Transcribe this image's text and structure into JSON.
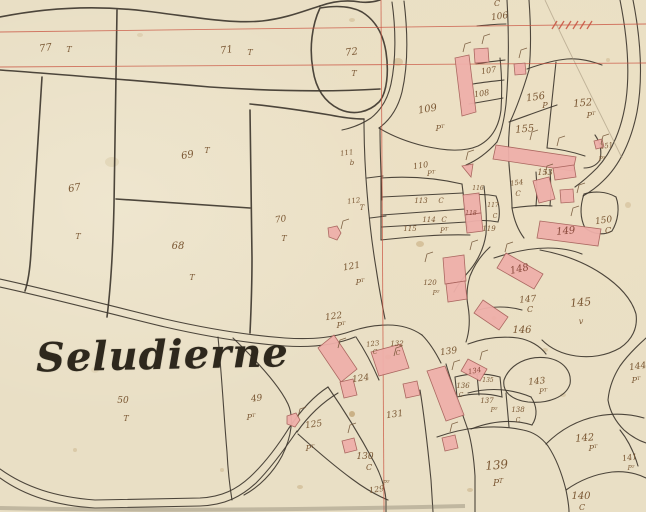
{
  "map": {
    "title": "Seludierne",
    "colors": {
      "paper": "#e9dfc5",
      "ink": "#3b342b",
      "sepia": "#7a5733",
      "building_fill": "#efb0aa",
      "building_stroke": "#a8625c",
      "red_grid": "#c8503e",
      "stain": "#b08a52"
    },
    "grid": {
      "red_lines": [
        "M0,32 L646,24",
        "M0,67 L646,63",
        "M381,0 L384,512"
      ],
      "hatches": [
        552,
        559,
        566,
        573,
        580,
        587
      ],
      "hatch_y": 29
    },
    "faint_paths": [
      "M545,0 C568,50 596,105 622,158"
    ],
    "boundaries": [
      "M0,17 C45,8 95,5 145,11 C195,17 230,24 262,21 C288,18 306,10 320,6",
      "M320,6 C334,1 348,0 360,2 C368,3 374,2 380,0",
      "M320,8 C312,25 309,48 313,70 C316,90 325,102 339,109 C354,116 369,112 379,102 C387,93 389,72 386,52 C383,33 375,20 362,12 C349,5 332,6 320,8",
      "M0,70 C70,75 140,81 210,87 C270,91 330,92 380,89",
      "M42,77 C38,140 34,200 31,252 C30,270 28,282 25,291",
      "M117,10 C116,80 115,150 114,205 C113,250 111,285 107,317",
      "M116,199 C160,202 205,205 250,208",
      "M250,110 C251,160 251,210 252,258 C252,288 251,312 250,333",
      "M250,104 C280,107 306,111 330,115 C345,118 356,119 364,119",
      "M392,2 C396,30 396,60 391,84 C388,98 381,110 371,118 C362,124 352,128 342,130",
      "M404,1 C408,34 408,66 402,92 C398,108 390,120 379,128",
      "M379,128 C392,136 408,142 424,146 C446,151 464,152 478,146 C492,139 499,126 501,110 C502,94 502,76 500,58",
      "M364,119 C364,144 365,168 367,192 C369,218 372,244 376,268 C379,288 382,304 385,319",
      "M380,128 C380,152 381,176 382,200",
      "M367,178 L383,176",
      "M370,218 L386,216",
      "M381,178 C408,176 436,178 462,184",
      "M382,197 L463,193",
      "M382,215 L465,209",
      "M382,227 L467,222",
      "M381,240 C410,237 440,234 470,235",
      "M381,178 L381,240",
      "M462,184 C464,200 466,216 468,230",
      "M0,279 C55,291 115,307 165,319 C200,327 245,335 285,338 C315,340 335,337 352,331",
      "M0,287 C55,299 115,315 165,327 C200,335 245,343 285,346 C316,348 338,344 355,337",
      "M218,337 C222,378 224,418 227,452 C228,472 230,488 232,500",
      "M233,338 C262,366 280,387 288,404 C294,417 292,436 282,456 C273,473 259,487 244,495",
      "M0,469 C25,487 55,497 95,500 L200,498 C222,497 237,489 250,477 C264,464 277,447 289,428",
      "M0,478 C25,496 58,506 95,508 L200,506 C226,505 242,496 256,483 C270,469 284,450 297,431",
      "M289,428 C301,410 314,396 328,387",
      "M297,432 C309,415 323,402 338,393",
      "M328,387 C344,410 360,436 374,462 C381,475 385,488 386,500 L386,512",
      "M298,434 C318,452 337,468 352,479 C364,488 376,495 388,500",
      "M352,331 C364,327 376,325 388,325 C400,325 412,328 422,335",
      "M356,337 C366,352 373,366 379,380",
      "M422,335 C430,343 436,353 441,363",
      "M420,390 C425,420 428,450 431,480 L433,512",
      "M446,364 C453,388 461,410 468,430 C472,444 474,460 475,476 L475,512",
      "M437,437 C465,427 496,424 523,430 C534,432 542,438 548,446 C556,458 562,474 566,490 C568,500 569,507 569,512",
      "M468,393 C490,387 512,389 531,397",
      "M471,429 C492,421 513,419 532,425",
      "M506,393 L509,427",
      "M531,397 C537,406 538,416 532,425",
      "M455,377 C470,373 486,373 500,377 L502,397 C488,393 472,393 457,397 L455,377",
      "M477,375 L479,395",
      "M504,380 C510,364 528,355 548,358 C564,361 572,372 570,384 C566,397 548,404 528,402 C512,400 502,392 504,380",
      "M478,310 C492,306 508,306 522,310",
      "M468,344 C484,338 502,336 518,338 C530,340 540,346 546,354",
      "M540,250 C562,254 584,262 602,274 C620,286 632,300 636,314 C638,328 632,340 620,348 C606,356 590,358 576,356 C562,354 550,348 542,340",
      "M584,194 C580,206 580,218 585,228 C593,234 603,236 612,231 C618,221 620,208 616,197 C606,191 593,191 584,194",
      "M620,0 C627,35 630,70 626,100 C622,128 612,152 597,168 C589,176 582,182 575,187",
      "M633,0 C641,40 643,80 637,112 C631,142 619,166 603,181 C597,187 590,192 583,196",
      "M556,62 C553,90 550,119 547,148",
      "M527,69 C541,64 555,60 567,59 C579,58 591,61 602,65",
      "M509,122 C526,116 542,110 557,105",
      "M547,148 C560,149 573,152 585,156",
      "M595,135 C600,142 602,151 600,160 C596,166 590,168 584,168",
      "M646,338 C636,347 627,356 620,366 C613,377 609,389 608,400 C610,412 616,422 624,430 C632,437 640,441 646,443",
      "M546,444 C560,430 578,420 598,416 C614,413 630,414 644,418",
      "M566,490 C580,480 596,474 612,472 C624,471 636,473 646,478",
      "M620,430 C628,440 634,452 638,466",
      "M507,0 C509,35 509,70 506,104 C504,122 501,133 497,142",
      "M529,0 C531,28 531,52 529,70",
      "M529,70 C523,90 517,107 510,122",
      "M477,26 C487,25 497,24 506,24",
      "M476,64 C486,62 496,61 505,60",
      "M473,84 C484,82 495,81 504,80",
      "M469,104 C481,102 493,100 503,98",
      "M484,186 C486,204 487,220 486,234 C484,248 478,260 470,270 C464,277 458,284 454,292",
      "M466,196 C476,194 486,194 496,196 C500,206 500,216 498,222 C488,220 478,220 468,222",
      "M497,142 C488,152 478,160 466,165",
      "M490,247 C480,256 474,266 470,276 C467,286 466,296 468,306",
      "M468,306 C470,318 470,330 466,342",
      "M510,122 C508,140 508,158 510,176 C511,188 512,198 512,208",
      "M512,208 C514,220 518,230 524,238",
      "M536,172 C537,184 537,196 536,206",
      "M550,170 C551,184 551,196 550,206",
      "M512,208 C526,206 540,205 552,206",
      "M494,258 C512,252 530,248 548,248 C560,248 572,250 582,254"
    ],
    "buildings": [
      "455,58 469,55 476,112 462,116",
      "474,49 488,48 489,62 475,63",
      "514,64 525,63 526,74 515,75",
      "496,145 576,157 573,171 493,159",
      "553,168 574,165 576,177 555,180",
      "533,181 549,177 555,199 539,203",
      "560,190 573,189 574,202 561,203",
      "540,221 601,229 598,246 537,238",
      "506,253 543,274 534,289 497,268",
      "483,300 508,317 499,330 474,313",
      "468,359 487,369 480,381 461,371",
      "463,195 479,193 481,213 465,215",
      "465,215 481,213 483,231 467,233",
      "462,166 473,164 471,177",
      "328,228 337,226 341,233 337,240 329,237",
      "334,335 357,369 341,382 318,348",
      "371,352 401,344 409,368 379,376",
      "340,382 353,379 357,395 344,398",
      "403,384 417,381 420,395 406,398",
      "427,371 445,366 464,415 446,421",
      "442,438 455,435 458,448 445,451",
      "287,416 296,413 300,420 295,427 287,424",
      "342,441 354,438 357,450 345,453",
      "594,141 602,139 604,147 596,149",
      "443,258 464,255 466,281 445,284",
      "446,284 465,281 467,299 448,302"
    ],
    "ticks": [
      [
        463,
        52
      ],
      [
        482,
        44
      ],
      [
        519,
        58
      ],
      [
        530,
        140
      ],
      [
        557,
        146
      ],
      [
        571,
        216
      ],
      [
        545,
        174
      ],
      [
        577,
        193
      ],
      [
        480,
        360
      ],
      [
        341,
        229
      ],
      [
        298,
        417
      ],
      [
        348,
        433
      ],
      [
        450,
        432
      ],
      [
        394,
        356
      ],
      [
        452,
        370
      ],
      [
        470,
        250
      ],
      [
        466,
        160
      ],
      [
        425,
        262
      ],
      [
        505,
        252
      ],
      [
        601,
        144
      ],
      [
        338,
        348
      ]
    ],
    "stains": [
      [
        398,
        62,
        5,
        4,
        0.3
      ],
      [
        352,
        20,
        3,
        2,
        0.25
      ],
      [
        420,
        244,
        4,
        3,
        0.35
      ],
      [
        300,
        487,
        3,
        2,
        0.3
      ],
      [
        598,
        232,
        2,
        2,
        0.3
      ],
      [
        112,
        162,
        7,
        5,
        0.15
      ],
      [
        545,
        350,
        3,
        2,
        0.25
      ],
      [
        628,
        205,
        3,
        3,
        0.25
      ],
      [
        75,
        450,
        2,
        2,
        0.25
      ],
      [
        563,
        395,
        3,
        2,
        0.2
      ],
      [
        222,
        470,
        2,
        2,
        0.25
      ],
      [
        470,
        490,
        3,
        2,
        0.3
      ],
      [
        608,
        60,
        2,
        2,
        0.25
      ],
      [
        140,
        35,
        3,
        2,
        0.18
      ],
      [
        95,
        370,
        4,
        3,
        0.12
      ],
      [
        352,
        414,
        3,
        3,
        0.55
      ],
      [
        494,
        318,
        2.5,
        2,
        0.5
      ],
      [
        388,
        357,
        3,
        2.5,
        0.45
      ]
    ],
    "parcel_labels": [
      {
        "t": "77",
        "x": 46,
        "y": 51,
        "s": 10,
        "r": -8
      },
      {
        "t": "T",
        "x": 69,
        "y": 52,
        "s": 8
      },
      {
        "t": "71",
        "x": 227,
        "y": 53,
        "s": 10,
        "r": -8
      },
      {
        "t": "T",
        "x": 250,
        "y": 55,
        "s": 8
      },
      {
        "t": "72",
        "x": 352,
        "y": 55,
        "s": 10,
        "r": -8
      },
      {
        "t": "T",
        "x": 354,
        "y": 76,
        "s": 8
      },
      {
        "t": "69",
        "x": 188,
        "y": 158,
        "s": 10,
        "r": -10
      },
      {
        "t": "T",
        "x": 207,
        "y": 153,
        "s": 8
      },
      {
        "t": "67",
        "x": 75,
        "y": 191,
        "s": 10,
        "r": -10
      },
      {
        "t": "T",
        "x": 78,
        "y": 239,
        "s": 8
      },
      {
        "t": "68",
        "x": 178,
        "y": 249,
        "s": 10
      },
      {
        "t": "T",
        "x": 192,
        "y": 280,
        "s": 8
      },
      {
        "t": "70",
        "x": 281,
        "y": 222,
        "s": 9,
        "r": -8
      },
      {
        "t": "T",
        "x": 284,
        "y": 241,
        "s": 8
      },
      {
        "t": "50",
        "x": 123,
        "y": 403,
        "s": 9
      },
      {
        "t": "T",
        "x": 126,
        "y": 421,
        "s": 8
      },
      {
        "t": "49",
        "x": 257,
        "y": 401,
        "s": 9,
        "r": -8
      },
      {
        "t": "P^T",
        "x": 251,
        "y": 420,
        "s": 8
      },
      {
        "t": "125",
        "x": 314,
        "y": 427,
        "s": 9,
        "r": -8
      },
      {
        "t": "P^T",
        "x": 310,
        "y": 451,
        "s": 8
      },
      {
        "t": "C",
        "x": 497,
        "y": 6,
        "s": 8
      },
      {
        "t": "106",
        "x": 500,
        "y": 19,
        "s": 9,
        "r": -8
      },
      {
        "t": "107",
        "x": 489,
        "y": 73,
        "s": 8,
        "r": -8
      },
      {
        "t": "108",
        "x": 482,
        "y": 96,
        "s": 8,
        "r": -8
      },
      {
        "t": "109",
        "x": 428,
        "y": 112,
        "s": 10,
        "r": -10
      },
      {
        "t": "P^T",
        "x": 440,
        "y": 131,
        "s": 8
      },
      {
        "t": "110",
        "x": 421,
        "y": 168,
        "s": 8,
        "r": -8
      },
      {
        "t": "P^T",
        "x": 431,
        "y": 176,
        "s": 7
      },
      {
        "t": "111",
        "x": 347,
        "y": 155,
        "s": 7,
        "r": -8
      },
      {
        "t": "b",
        "x": 352,
        "y": 165,
        "s": 7
      },
      {
        "t": "112",
        "x": 354,
        "y": 203,
        "s": 7,
        "r": -8
      },
      {
        "t": "T",
        "x": 362,
        "y": 210,
        "s": 7
      },
      {
        "t": "113",
        "x": 421,
        "y": 203,
        "s": 7
      },
      {
        "t": "C",
        "x": 441,
        "y": 203,
        "s": 7
      },
      {
        "t": "114",
        "x": 429,
        "y": 222,
        "s": 7
      },
      {
        "t": "C",
        "x": 444,
        "y": 222,
        "s": 7
      },
      {
        "t": "115",
        "x": 410,
        "y": 231,
        "s": 7
      },
      {
        "t": "P^T",
        "x": 444,
        "y": 233,
        "s": 7
      },
      {
        "t": "116",
        "x": 478,
        "y": 190,
        "s": 6
      },
      {
        "t": "117",
        "x": 493,
        "y": 207,
        "s": 6
      },
      {
        "t": "C",
        "x": 495,
        "y": 218,
        "s": 6
      },
      {
        "t": "118",
        "x": 471,
        "y": 215,
        "s": 6,
        "c": "#8a4a3c"
      },
      {
        "t": "119",
        "x": 489,
        "y": 231,
        "s": 7
      },
      {
        "t": "120",
        "x": 430,
        "y": 285,
        "s": 7
      },
      {
        "t": "P^T",
        "x": 436,
        "y": 295,
        "s": 6
      },
      {
        "t": "156",
        "x": 536,
        "y": 100,
        "s": 10,
        "r": -8
      },
      {
        "t": "P",
        "x": 545,
        "y": 108,
        "s": 8
      },
      {
        "t": "152",
        "x": 583,
        "y": 106,
        "s": 10,
        "r": -5
      },
      {
        "t": "P^T",
        "x": 591,
        "y": 118,
        "s": 8
      },
      {
        "t": "155",
        "x": 525,
        "y": 132,
        "s": 10,
        "r": -5
      },
      {
        "t": "153",
        "x": 545,
        "y": 175,
        "s": 8
      },
      {
        "t": "154",
        "x": 517,
        "y": 185,
        "s": 7,
        "r": -8
      },
      {
        "t": "C",
        "x": 518,
        "y": 196,
        "s": 7
      },
      {
        "t": "151",
        "x": 607,
        "y": 148,
        "s": 7,
        "r": -10
      },
      {
        "t": "P^T",
        "x": 602,
        "y": 161,
        "s": 6
      },
      {
        "t": "150",
        "x": 604,
        "y": 223,
        "s": 9,
        "r": -8
      },
      {
        "t": "C",
        "x": 608,
        "y": 233,
        "s": 8
      },
      {
        "t": "149",
        "x": 566,
        "y": 234,
        "s": 10,
        "r": -5,
        "c": "#8a4a3c"
      },
      {
        "t": "148",
        "x": 520,
        "y": 272,
        "s": 10,
        "r": -12,
        "c": "#8a4a3c"
      },
      {
        "t": "147",
        "x": 528,
        "y": 302,
        "s": 9,
        "r": -5
      },
      {
        "t": "C",
        "x": 530,
        "y": 312,
        "s": 8
      },
      {
        "t": "146",
        "x": 522,
        "y": 333,
        "s": 10
      },
      {
        "t": "145",
        "x": 581,
        "y": 306,
        "s": 11,
        "r": -5
      },
      {
        "t": "v",
        "x": 581,
        "y": 324,
        "s": 8
      },
      {
        "t": "144",
        "x": 638,
        "y": 369,
        "s": 9,
        "r": -8
      },
      {
        "t": "P^T",
        "x": 636,
        "y": 383,
        "s": 8
      },
      {
        "t": "143",
        "x": 537,
        "y": 384,
        "s": 9,
        "r": -5
      },
      {
        "t": "P^T",
        "x": 543,
        "y": 394,
        "s": 7
      },
      {
        "t": "134",
        "x": 475,
        "y": 373,
        "s": 7,
        "r": -10,
        "c": "#8a4a3c"
      },
      {
        "t": "136",
        "x": 463,
        "y": 388,
        "s": 7
      },
      {
        "t": "C",
        "x": 461,
        "y": 397,
        "s": 6
      },
      {
        "t": "135",
        "x": 488,
        "y": 382,
        "s": 6
      },
      {
        "t": "137",
        "x": 487,
        "y": 403,
        "s": 7
      },
      {
        "t": "P^T",
        "x": 494,
        "y": 412,
        "s": 6
      },
      {
        "t": "138",
        "x": 518,
        "y": 412,
        "s": 7
      },
      {
        "t": "C",
        "x": 518,
        "y": 422,
        "s": 6
      },
      {
        "t": "142",
        "x": 585,
        "y": 441,
        "s": 10,
        "r": -5
      },
      {
        "t": "P^T",
        "x": 593,
        "y": 451,
        "s": 8
      },
      {
        "t": "141",
        "x": 630,
        "y": 460,
        "s": 8,
        "r": -8
      },
      {
        "t": "P^T",
        "x": 631,
        "y": 470,
        "s": 6
      },
      {
        "t": "140",
        "x": 581,
        "y": 499,
        "s": 10
      },
      {
        "t": "C",
        "x": 582,
        "y": 510,
        "s": 8
      },
      {
        "t": "139",
        "x": 497,
        "y": 469,
        "s": 12,
        "r": -5
      },
      {
        "t": "P^T",
        "x": 498,
        "y": 486,
        "s": 9
      },
      {
        "t": "139",
        "x": 449,
        "y": 354,
        "s": 9,
        "r": -8
      },
      {
        "t": "121",
        "x": 352,
        "y": 269,
        "s": 9,
        "r": -10
      },
      {
        "t": "P^T",
        "x": 360,
        "y": 285,
        "s": 8
      },
      {
        "t": "122",
        "x": 334,
        "y": 319,
        "s": 9,
        "r": -8
      },
      {
        "t": "P^T",
        "x": 341,
        "y": 328,
        "s": 8
      },
      {
        "t": "123",
        "x": 373,
        "y": 346,
        "s": 7,
        "r": -8
      },
      {
        "t": "C",
        "x": 375,
        "y": 354,
        "s": 6
      },
      {
        "t": "132",
        "x": 397,
        "y": 346,
        "s": 7
      },
      {
        "t": "C",
        "x": 398,
        "y": 355,
        "s": 6
      },
      {
        "t": "124",
        "x": 361,
        "y": 381,
        "s": 9,
        "r": -8
      },
      {
        "t": "131",
        "x": 395,
        "y": 417,
        "s": 9,
        "r": -8
      },
      {
        "t": "130",
        "x": 365,
        "y": 459,
        "s": 9
      },
      {
        "t": "C",
        "x": 369,
        "y": 470,
        "s": 8
      },
      {
        "t": "129",
        "x": 377,
        "y": 492,
        "s": 8,
        "r": -8
      },
      {
        "t": "P^T",
        "x": 386,
        "y": 485,
        "s": 6
      }
    ]
  }
}
